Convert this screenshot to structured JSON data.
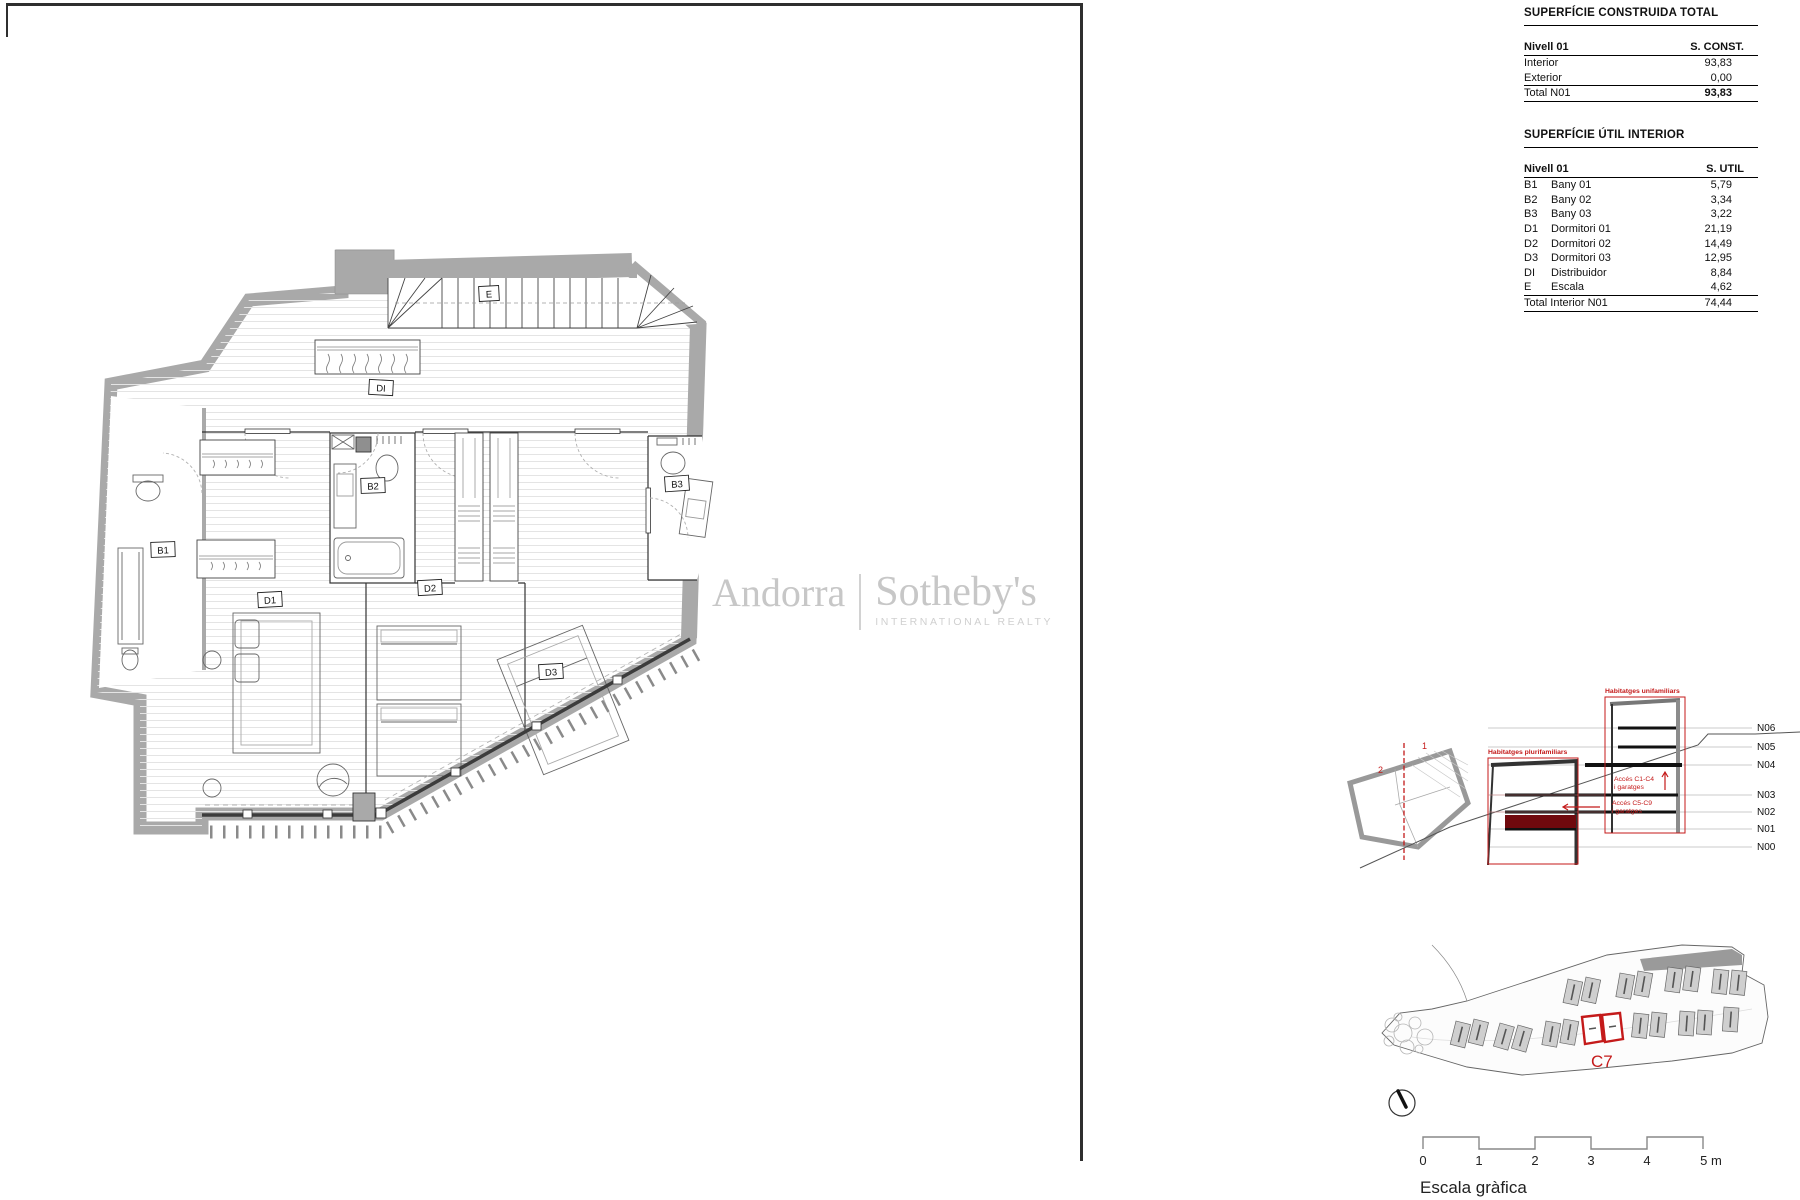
{
  "tables": {
    "constructed": {
      "title": "SUPERFÍCIE CONSTRUIDA TOTAL",
      "header": {
        "level": "Nivell 01",
        "col": "S. CONST."
      },
      "rows": [
        {
          "label": "Interior",
          "value": "93,83"
        },
        {
          "label": "Exterior",
          "value": "0,00"
        }
      ],
      "total": {
        "label": "Total N01",
        "value": "93,83"
      }
    },
    "useful": {
      "title": "SUPERFÍCIE ÚTIL INTERIOR",
      "header": {
        "level": "Nivell 01",
        "col": "S. UTIL"
      },
      "rows": [
        {
          "code": "B1",
          "label": "Bany 01",
          "value": "5,79"
        },
        {
          "code": "B2",
          "label": "Bany 02",
          "value": "3,34"
        },
        {
          "code": "B3",
          "label": "Bany 03",
          "value": "3,22"
        },
        {
          "code": "D1",
          "label": "Dormitori 01",
          "value": "21,19"
        },
        {
          "code": "D2",
          "label": "Dormitori 02",
          "value": "14,49"
        },
        {
          "code": "D3",
          "label": "Dormitori 03",
          "value": "12,95"
        },
        {
          "code": "DI",
          "label": "Distribuidor",
          "value": "8,84"
        },
        {
          "code": "E",
          "label": "Escala",
          "value": "4,62"
        }
      ],
      "total": {
        "label": "Total Interior N01",
        "value": "74,44"
      }
    }
  },
  "plan": {
    "labels": {
      "e": "E",
      "di": "DI",
      "b1": "B1",
      "b2": "B2",
      "b3": "B3",
      "d1": "D1",
      "d2": "D2",
      "d3": "D3"
    }
  },
  "watermark": {
    "brand_left": "Andorra",
    "brand_right": "Sotheby's",
    "subtitle": "INTERNATIONAL REALTY"
  },
  "section": {
    "label_unifamiliars": "Habitatges unifamiliars",
    "label_plurifamiliars": "Habitatges plurifamiliars",
    "access_top_1": "Accés C1-C4",
    "access_top_2": "i garatges",
    "access_bottom_1": "Accés C5-C9",
    "access_bottom_2": "i garatges",
    "levels": [
      "N06",
      "N05",
      "N04",
      "N03",
      "N02",
      "N01",
      "N00"
    ],
    "key_marks": [
      "2",
      "1"
    ]
  },
  "site": {
    "unit_label": "C7"
  },
  "scalebar": {
    "ticks": [
      "0",
      "1",
      "2",
      "3",
      "4"
    ],
    "last": "5 m",
    "caption": "Escala gràfica"
  },
  "colors": {
    "accent_red": "#c41a1a",
    "dark_red": "#70090d",
    "wall_gray": "#a9a9a9"
  }
}
